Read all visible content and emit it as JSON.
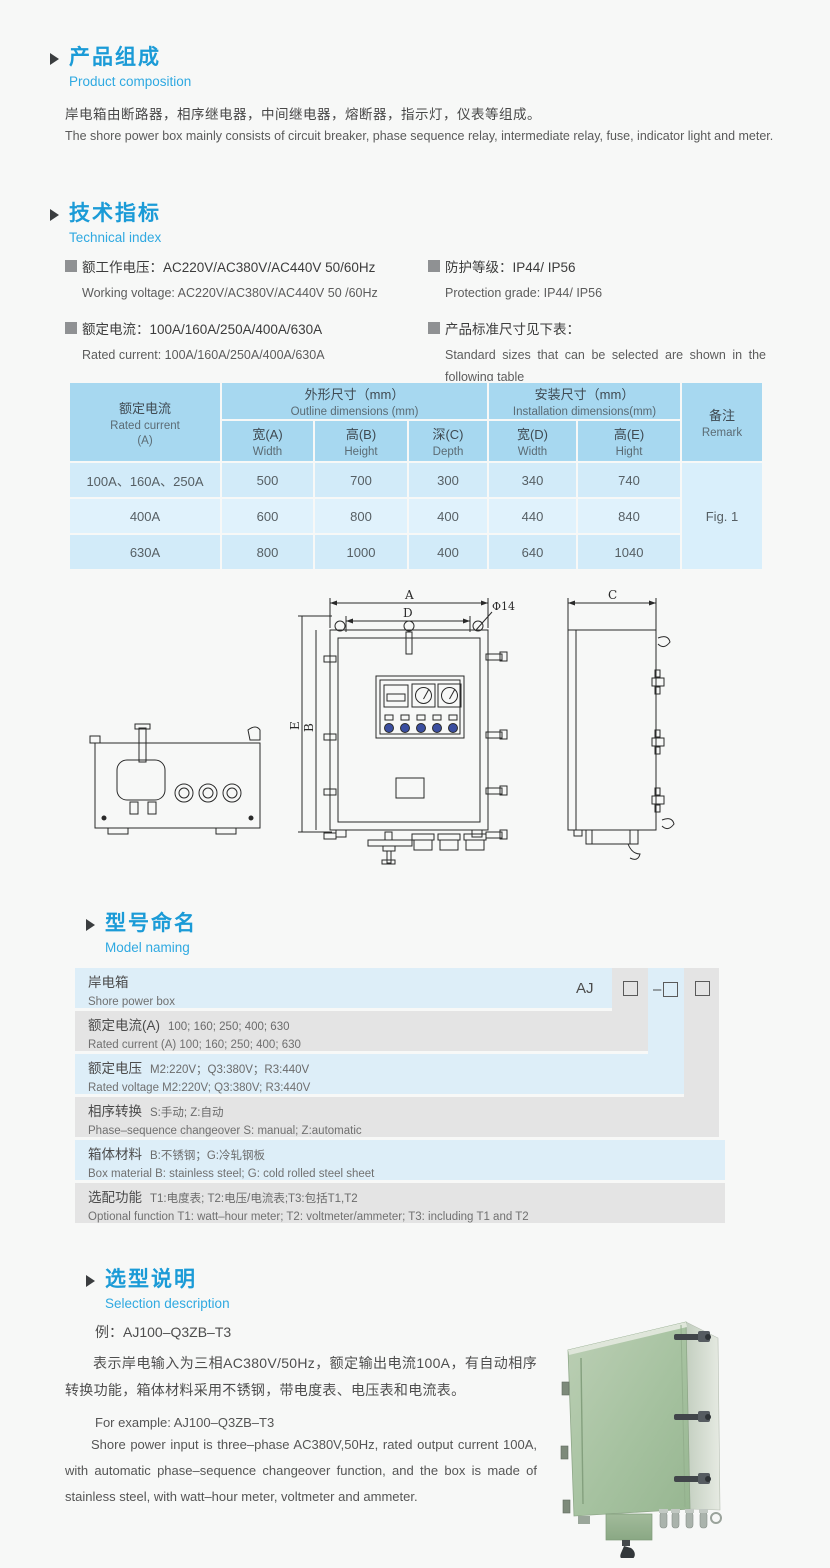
{
  "colors": {
    "accent_blue": "#1b9bd7",
    "subtitle_blue": "#2fa9e1",
    "table_header_blue": "#a7d8f0",
    "table_row_blue": "#d2ebf9",
    "table_row_blue_light": "#e0f2fc",
    "ladder_blue": "#ddeef8",
    "ladder_gray": "#e4e4e4",
    "indicator_blue": "#3a4ea0",
    "photo_green": "#a5c19f"
  },
  "section_product": {
    "title_zh": "产品组成",
    "title_en": "Product  composition",
    "body_zh": "岸电箱由断路器，相序继电器，中间继电器，熔断器，指示灯，仪表等组成。",
    "body_en": "The shore power box mainly consists of circuit breaker, phase sequence relay, intermediate relay, fuse, indicator light and meter."
  },
  "section_technical": {
    "title_zh": "技术指标",
    "title_en": "Technical index",
    "specs": [
      {
        "zh": "额工作电压：AC220V/AC380V/AC440V  50/60Hz",
        "en": "Working voltage: AC220V/AC380V/AC440V 50 /60Hz"
      },
      {
        "zh": "额定电流：100A/160A/250A/400A/630A",
        "en": "Rated current: 100A/160A/250A/400A/630A"
      },
      {
        "zh": "防护等级：IP44/ IP56",
        "en": "Protection grade: IP44/ IP56"
      },
      {
        "zh": "产品标准尺寸见下表：",
        "en": "Standard sizes that can be selected are shown in the following table"
      }
    ]
  },
  "dimension_table": {
    "header": {
      "current_zh": "额定电流",
      "current_en": "Rated current",
      "current_unit": "(A)",
      "outline_zh": "外形尺寸（mm）",
      "outline_en": "Outline dimensions (mm)",
      "install_zh": "安装尺寸（mm）",
      "install_en": "Installation dimensions(mm)",
      "remark_zh": "备注",
      "remark_en": "Remark",
      "sub": [
        {
          "zh": "宽(A)",
          "en": "Width"
        },
        {
          "zh": "高(B)",
          "en": "Height"
        },
        {
          "zh": "深(C)",
          "en": "Depth"
        },
        {
          "zh": "宽(D)",
          "en": "Width"
        },
        {
          "zh": "高(E)",
          "en": "Hight"
        }
      ]
    },
    "rows": [
      {
        "current": "100A、160A、250A",
        "width": "500",
        "height": "700",
        "depth": "300",
        "iwidth": "340",
        "iheight": "740"
      },
      {
        "current": "400A",
        "width": "600",
        "height": "800",
        "depth": "400",
        "iwidth": "440",
        "iheight": "840"
      },
      {
        "current": "630A",
        "width": "800",
        "height": "1000",
        "depth": "400",
        "iwidth": "640",
        "iheight": "1040"
      }
    ],
    "remark": "Fig. 1"
  },
  "drawing": {
    "labels": {
      "dim_a": "A",
      "dim_b": "B",
      "dim_c": "C",
      "dim_d": "D",
      "dim_e": "E",
      "hole": "Φ14"
    }
  },
  "section_model": {
    "title_zh": "型号命名",
    "title_en": "Model naming",
    "code": {
      "prefix": "AJ",
      "dash": "–",
      "box_symbol": "□"
    },
    "rows": [
      {
        "label_zh": "岸电箱",
        "detail_zh": "",
        "label_en": "Shore power box",
        "detail_en": ""
      },
      {
        "label_zh": "额定电流(A)",
        "detail_zh": "100; 160; 250; 400; 630",
        "label_en": "Rated current (A)",
        "detail_en": "100; 160; 250; 400; 630"
      },
      {
        "label_zh": "额定电压",
        "detail_zh": "M2:220V；Q3:380V；R3:440V",
        "label_en": "Rated voltage",
        "detail_en": "M2:220V;  Q3:380V;  R3:440V"
      },
      {
        "label_zh": "相序转换",
        "detail_zh": "S:手动; Z:自动",
        "label_en": "Phase–sequence changeover",
        "detail_en": "S: manual;  Z:automatic"
      },
      {
        "label_zh": "箱体材料",
        "detail_zh": "B:不锈钢；G:冷轧钢板",
        "label_en": "Box material",
        "detail_en": "B: stainless steel; G: cold rolled steel sheet"
      },
      {
        "label_zh": "选配功能",
        "detail_zh": "T1:电度表;  T2:电压/电流表;T3:包括T1,T2",
        "label_en": "Optional function",
        "detail_en": "T1: watt–hour meter; T2: voltmeter/ammeter; T3: including T1 and T2"
      }
    ]
  },
  "section_selection": {
    "title_zh": "选型说明",
    "title_en": "Selection description",
    "example_zh": "例：AJ100–Q3ZB–T3",
    "body_zh": "表示岸电输入为三相AC380V/50Hz，额定输出电流100A，有自动相序转换功能，箱体材料采用不锈钢，带电度表、电压表和电流表。",
    "example_en": "For example: AJ100–Q3ZB–T3",
    "body_en": "Shore power input is three–phase AC380V,50Hz, rated output current 100A, with automatic phase–sequence changeover function, and the box is made of stainless steel, with watt–hour meter, voltmeter and ammeter."
  }
}
